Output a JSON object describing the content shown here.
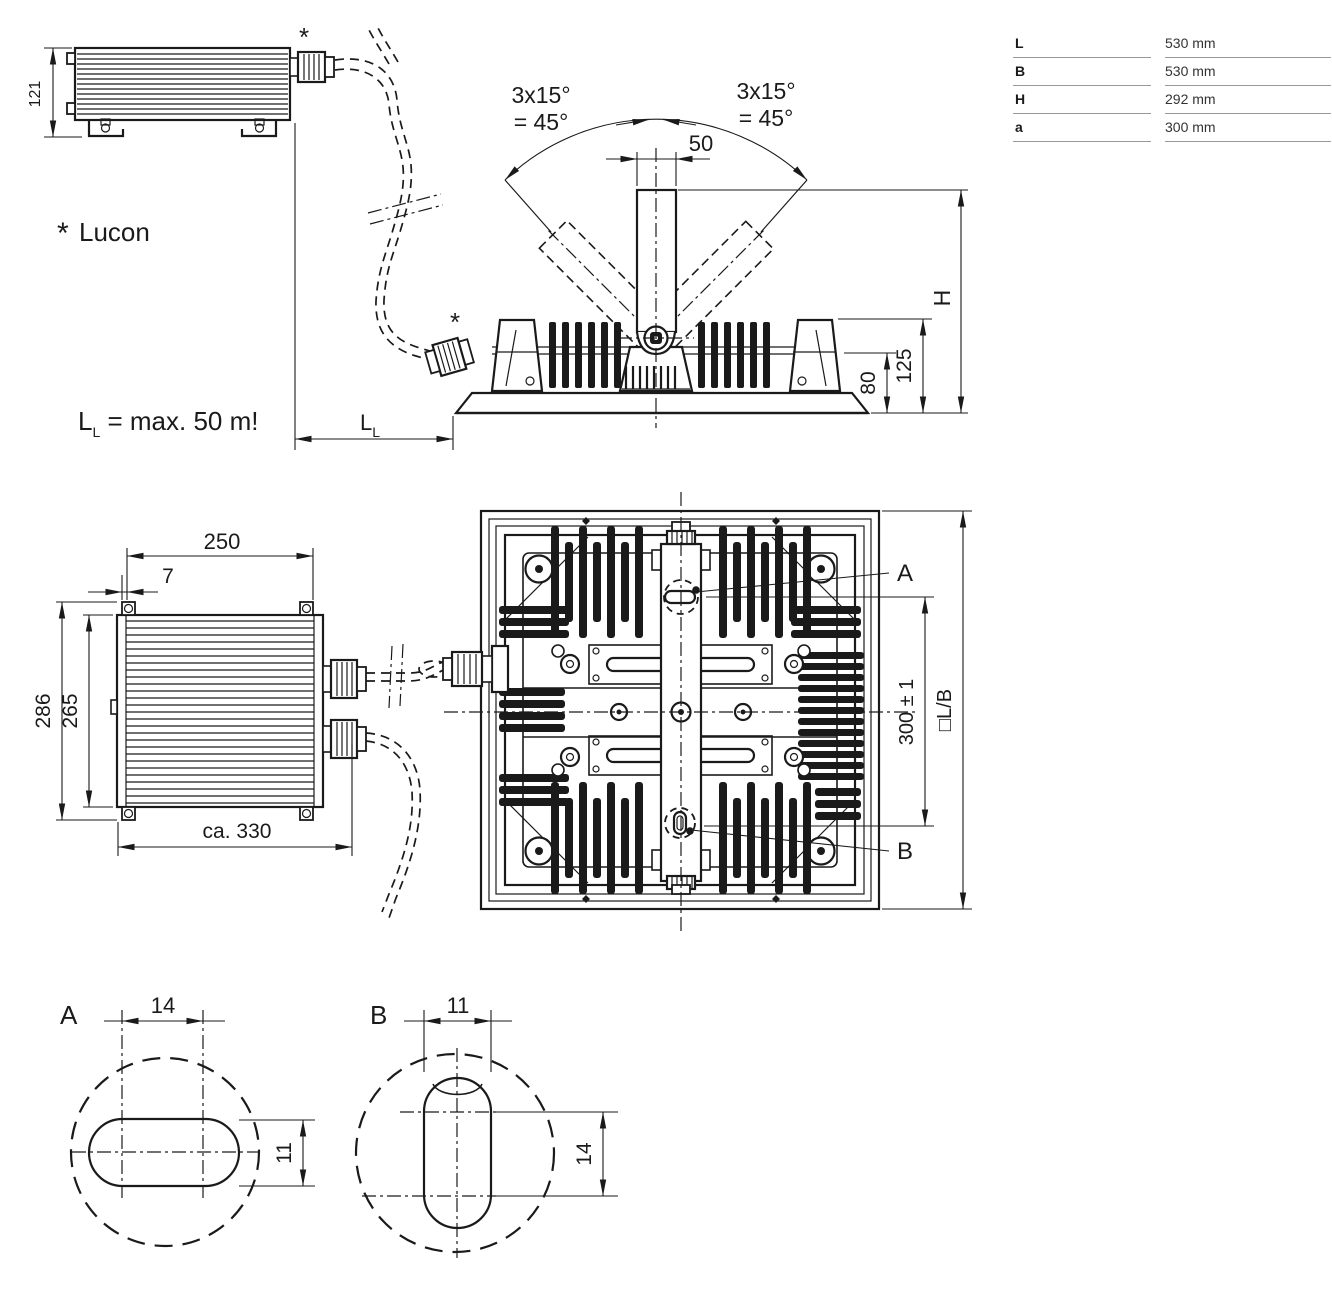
{
  "drawing": {
    "spec_table": {
      "rows": [
        {
          "label": "L",
          "value": "530 mm"
        },
        {
          "label": "B",
          "value": "530 mm"
        },
        {
          "label": "H",
          "value": "292 mm"
        },
        {
          "label": "a",
          "value": "300 mm"
        }
      ]
    },
    "notes": {
      "asterisk": "*",
      "component_note": "Lucon",
      "cable_note_main": "L",
      "cable_note_sub": "L",
      "cable_note_rest": " = max. 50 m!"
    },
    "front_view": {
      "tilt_line1": "3x15°",
      "tilt_line2": "= 45°",
      "bracket_width": "50",
      "height_label": "H",
      "dim_125": "125",
      "dim_80": "80",
      "cable_dim_main": "L",
      "cable_dim_sub": "L"
    },
    "ballast_side": {
      "height": "121"
    },
    "ballast_top": {
      "width_250": "250",
      "offset_7": "7",
      "height_286": "286",
      "height_265": "265",
      "width_330": "ca. 330"
    },
    "flood_top": {
      "callout_a": "A",
      "callout_b": "B",
      "hole_spacing": "300 ± 1",
      "outline_label": "□L/B"
    },
    "detail_a": {
      "title": "A",
      "slot_length": "14",
      "slot_width": "11"
    },
    "detail_b": {
      "title": "B",
      "slot_width": "11",
      "slot_length": "14"
    }
  }
}
